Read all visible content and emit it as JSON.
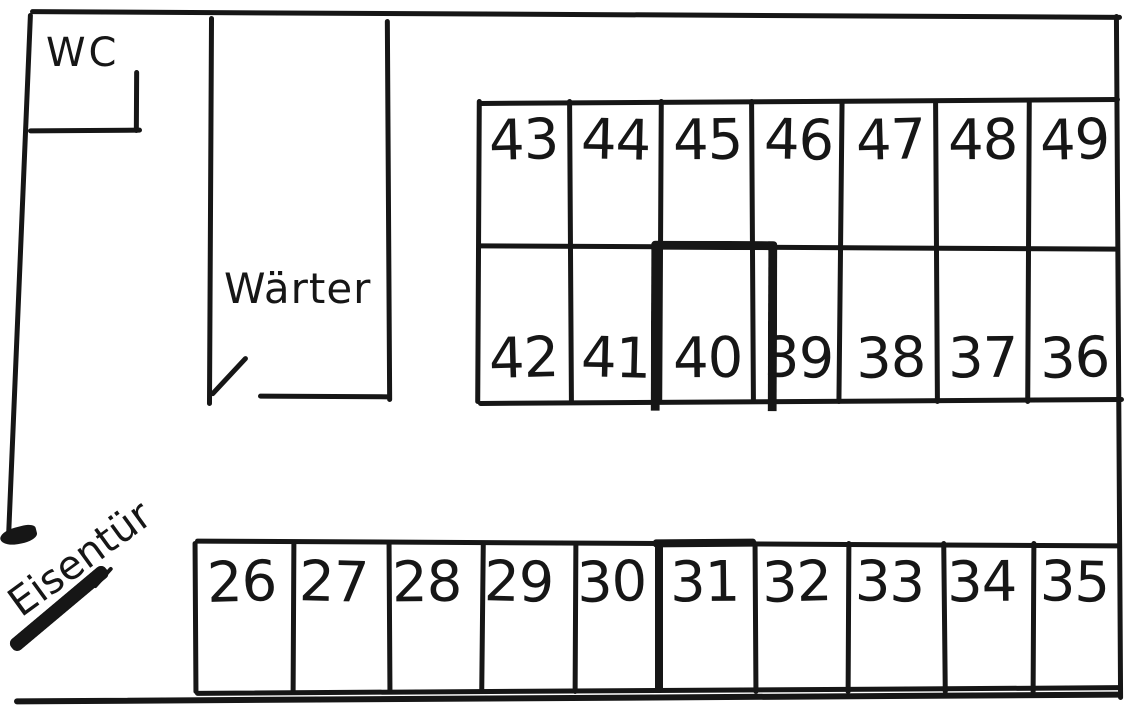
{
  "plan": {
    "rooms": {
      "wc": {
        "label": "WC"
      },
      "waerter": {
        "label": "Wärter"
      }
    },
    "iron_door": {
      "label": "Eisentür"
    },
    "cell_rows": {
      "upper_front": {
        "cells": [
          "43",
          "44",
          "45",
          "46",
          "47",
          "48",
          "49"
        ]
      },
      "upper_back": {
        "cells": [
          "42",
          "41",
          "40",
          "39",
          "38",
          "37",
          "36"
        ]
      },
      "bottom": {
        "cells": [
          "26",
          "27",
          "28",
          "29",
          "30",
          "31",
          "32",
          "33",
          "34",
          "35"
        ]
      }
    },
    "emphasis": {
      "thick_outline_cell": "40",
      "thick_wall_cell": "31"
    },
    "colors": {
      "ink": "#161616",
      "paper": "#ffffff"
    }
  }
}
